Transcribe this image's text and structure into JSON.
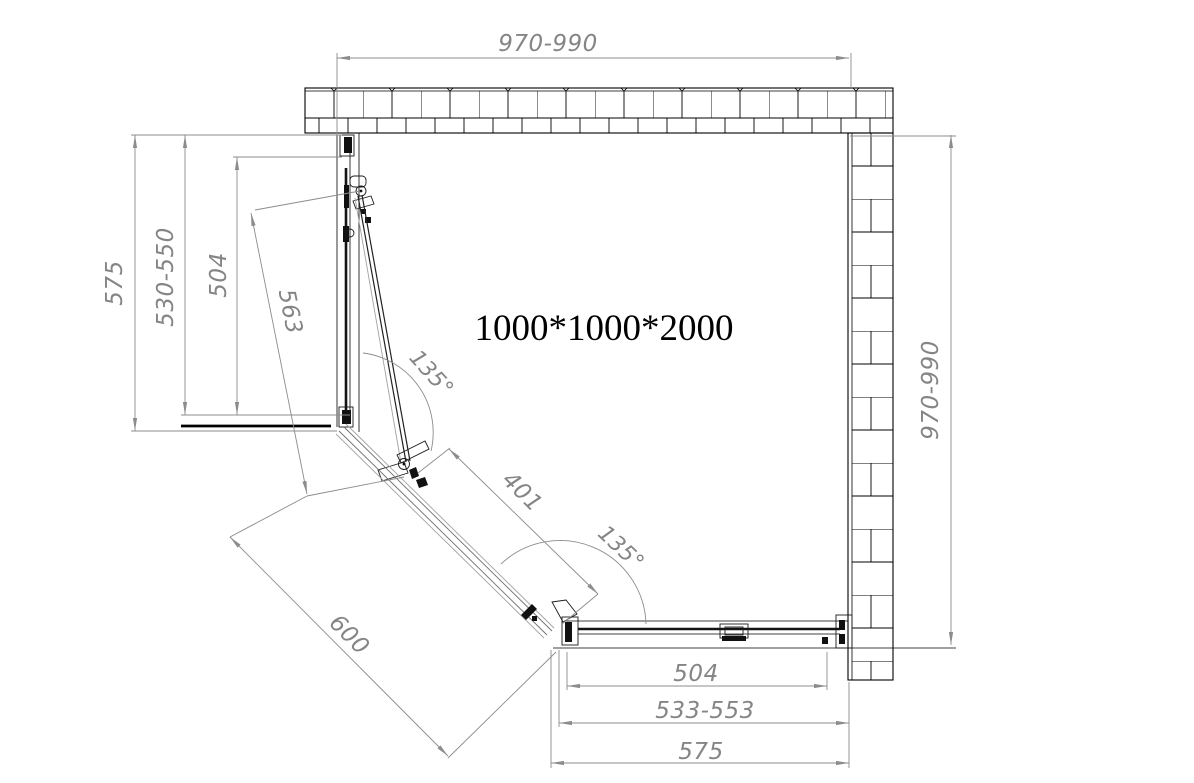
{
  "drawing": {
    "title": "1000*1000*2000",
    "dimensions": {
      "top_width": "970-990",
      "right_depth": "970-990",
      "left_total": "575",
      "left_adjust_range": "530-550",
      "left_glass": "504",
      "door_width": "563",
      "diagonal_opening": "401",
      "diagonal_total": "600",
      "bottom_glass": "504",
      "bottom_adjust_range": "533-553",
      "bottom_total": "575"
    },
    "angles": {
      "left": "135°",
      "right": "135°"
    },
    "colors": {
      "outline": "#000000",
      "dimension": "#8c8c8c",
      "dim_text": "#858585",
      "glass": "#141414"
    }
  }
}
